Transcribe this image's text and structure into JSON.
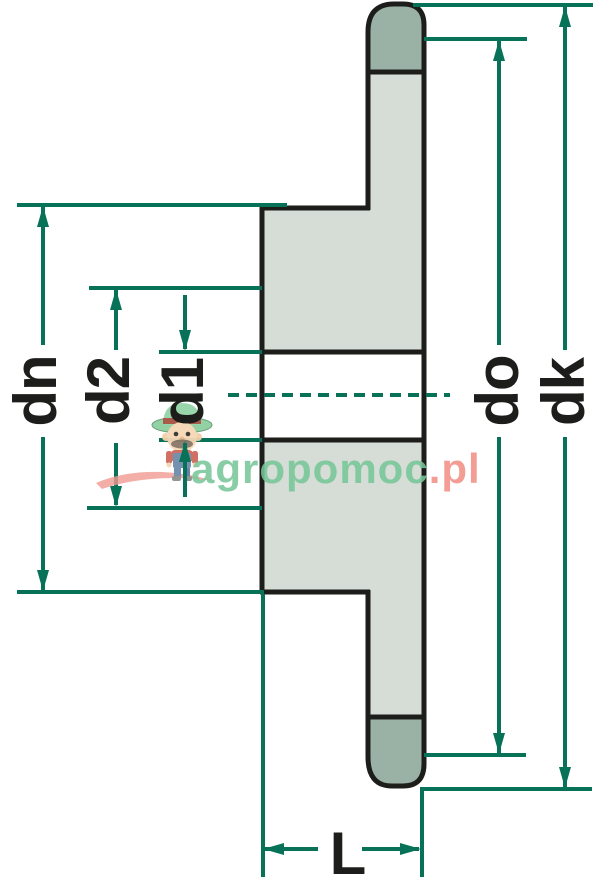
{
  "figure": {
    "labels": {
      "dn": "dn",
      "d2": "d2",
      "d1": "d1",
      "do": "do",
      "dk": "dk",
      "L": "L"
    }
  },
  "watermark": {
    "green": "agropomoc",
    "pink": ".pl"
  },
  "colors": {
    "background": "#ffffff",
    "outline": "#1d1d1b",
    "body_fill": "#d6dcd6",
    "tooth_tip_fill": "#9ab2a6",
    "dimension_line": "#077258",
    "label_text": "#1d1d1b",
    "watermark_green": "#78c698",
    "watermark_pink": "#f2928a"
  }
}
